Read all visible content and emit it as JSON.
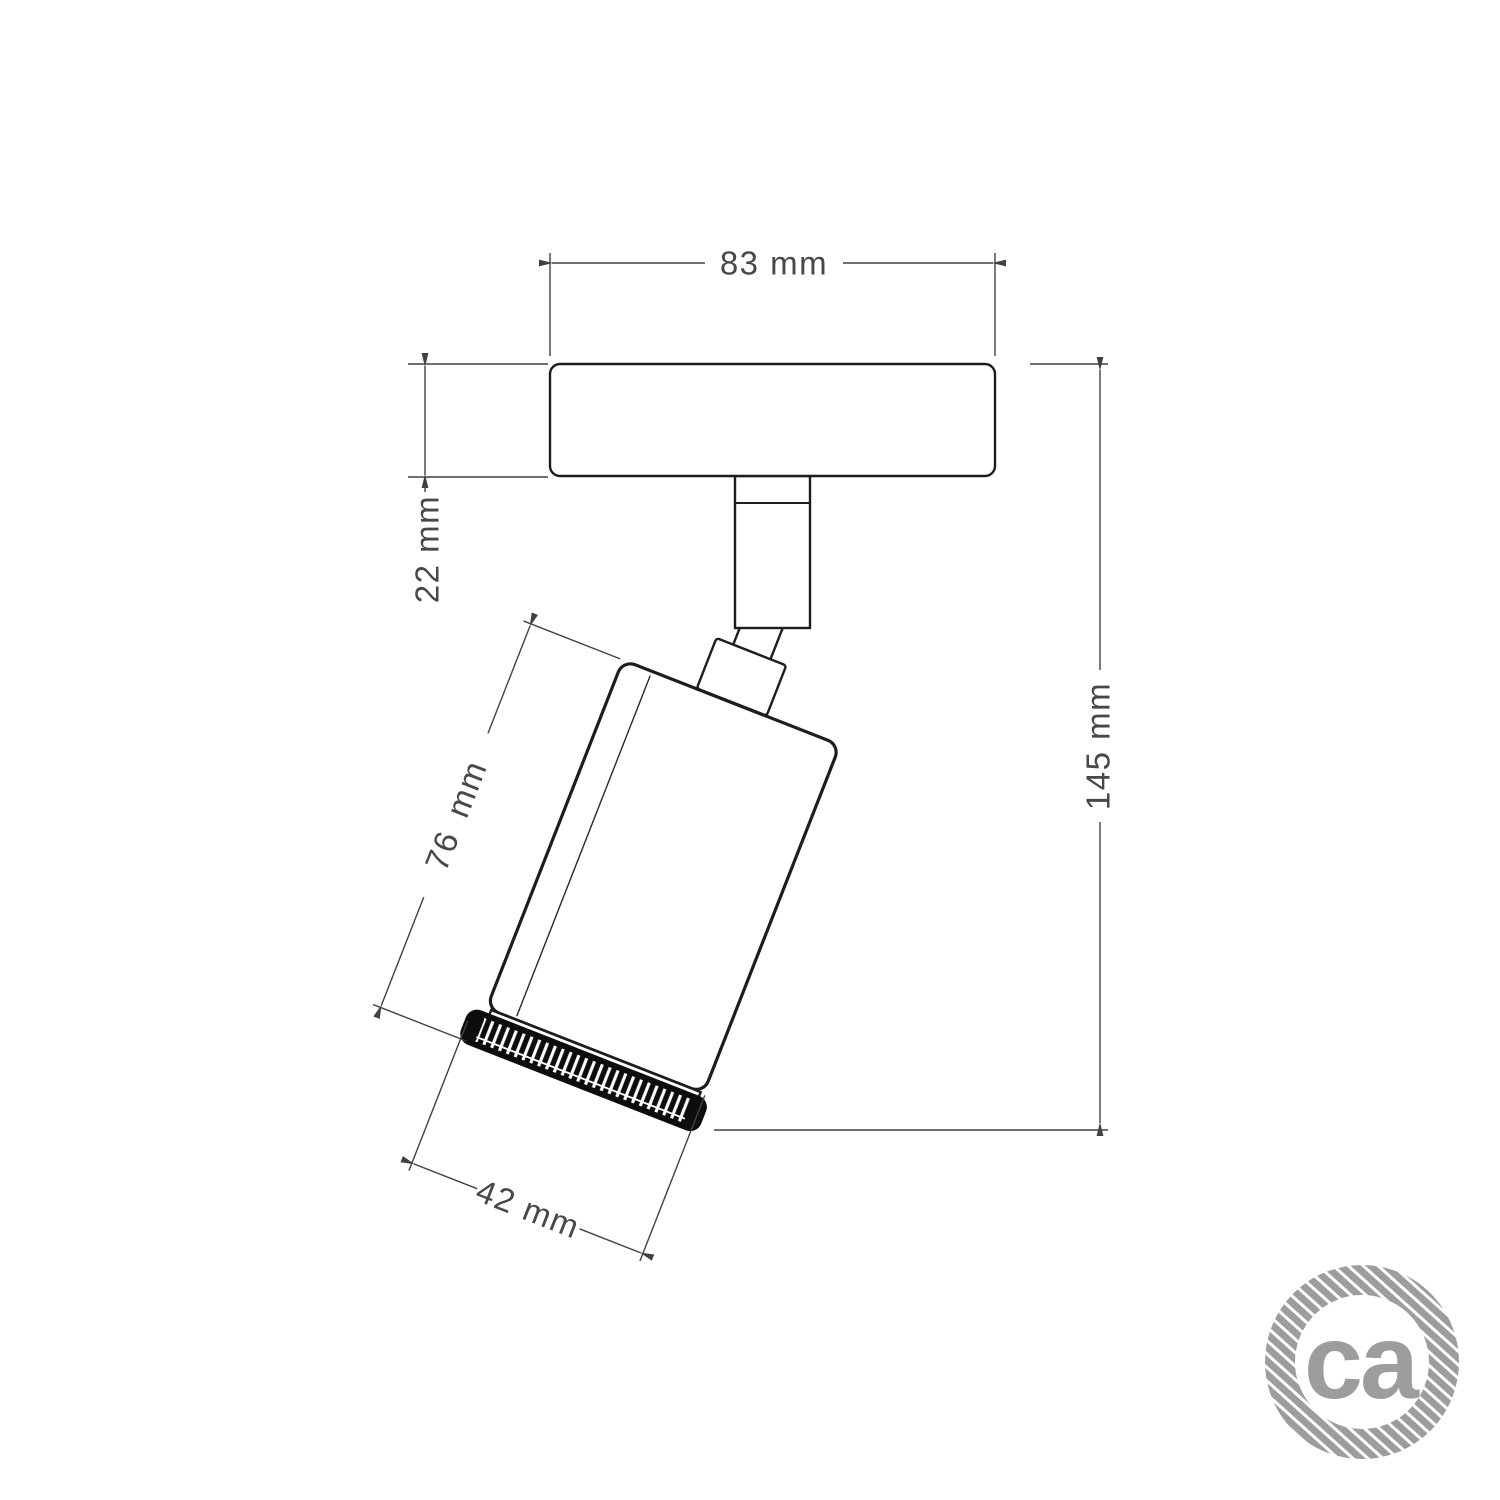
{
  "drawing": {
    "dim_plate_width": "83 mm",
    "dim_plate_thickness": "22 mm",
    "dim_body_length": "76 mm",
    "dim_body_diameter": "42 mm",
    "dim_total_height": "145 mm"
  },
  "logo": {
    "text": "ca"
  },
  "colors": {
    "background": "#ffffff",
    "object_outline": "#1d1d1f",
    "dimension_line": "#3f4245",
    "dimension_text": "#46484b",
    "knurl_black": "#0d0d0d",
    "logo_gray": "#9d9d9d"
  }
}
